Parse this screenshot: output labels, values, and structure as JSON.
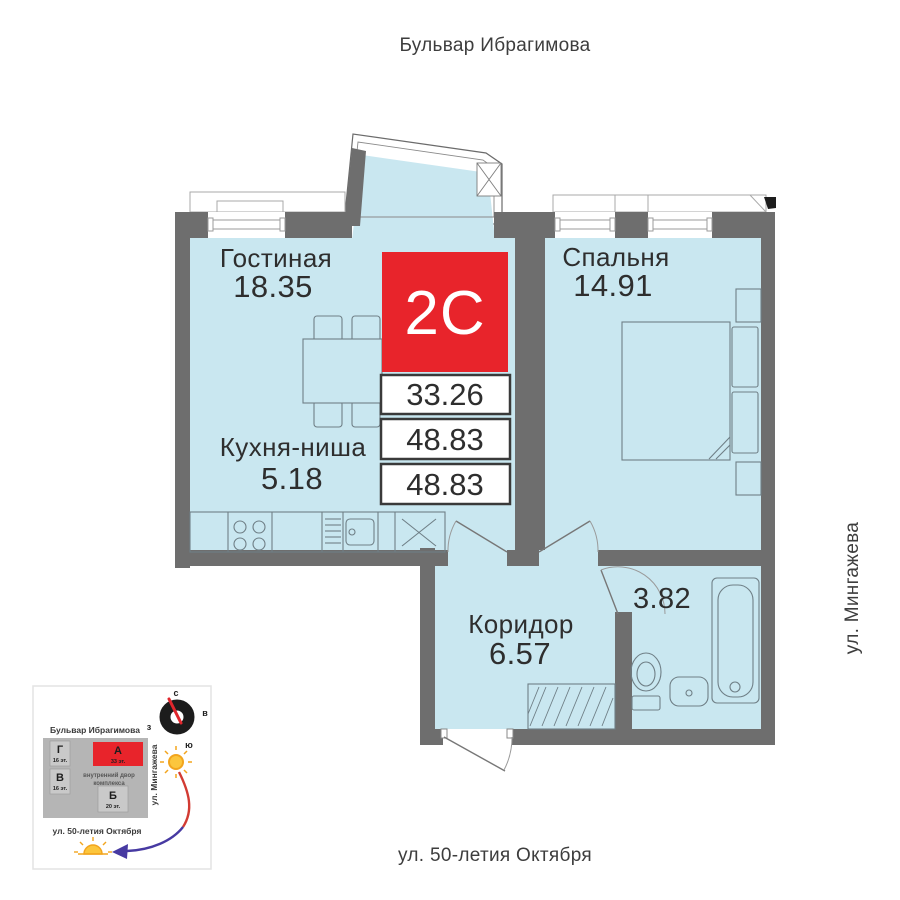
{
  "streets": {
    "top": "Бульвар Ибрагимова",
    "right": "ул. Мингажева",
    "bottom": "ул. 50-летия Октября"
  },
  "unit": {
    "type_label": "2С",
    "areas": [
      "33.26",
      "48.83",
      "48.83"
    ]
  },
  "rooms": {
    "living": {
      "name": "Гостиная",
      "area": "18.35"
    },
    "bedroom": {
      "name": "Спальня",
      "area": "14.91"
    },
    "kitchen": {
      "name": "Кухня-ниша",
      "area": "5.18"
    },
    "corridor": {
      "name": "Коридор",
      "area": "6.57"
    },
    "bathroom": {
      "area": "3.82"
    }
  },
  "minimap": {
    "street_top": "Бульвар Ибрагимова",
    "street_right": "ул. Мингажева",
    "street_bottom": "ул. 50-летия Октября",
    "courtyard_line1": "внутренний двор",
    "courtyard_line2": "комплекса",
    "compass": {
      "north": "с",
      "east": "в",
      "west": "з",
      "south": "ю"
    },
    "buildings": [
      {
        "label": "Г",
        "floors": "16 эт."
      },
      {
        "label": "В",
        "floors": "16 эт."
      },
      {
        "label": "А",
        "floors": "33 эт."
      },
      {
        "label": "Б",
        "floors": "20 эт."
      }
    ]
  },
  "colors": {
    "wall": "#6e6e6e",
    "room_fill": "#c9e7f0",
    "accent_red": "#e8242b",
    "text": "#2e2e2e"
  }
}
